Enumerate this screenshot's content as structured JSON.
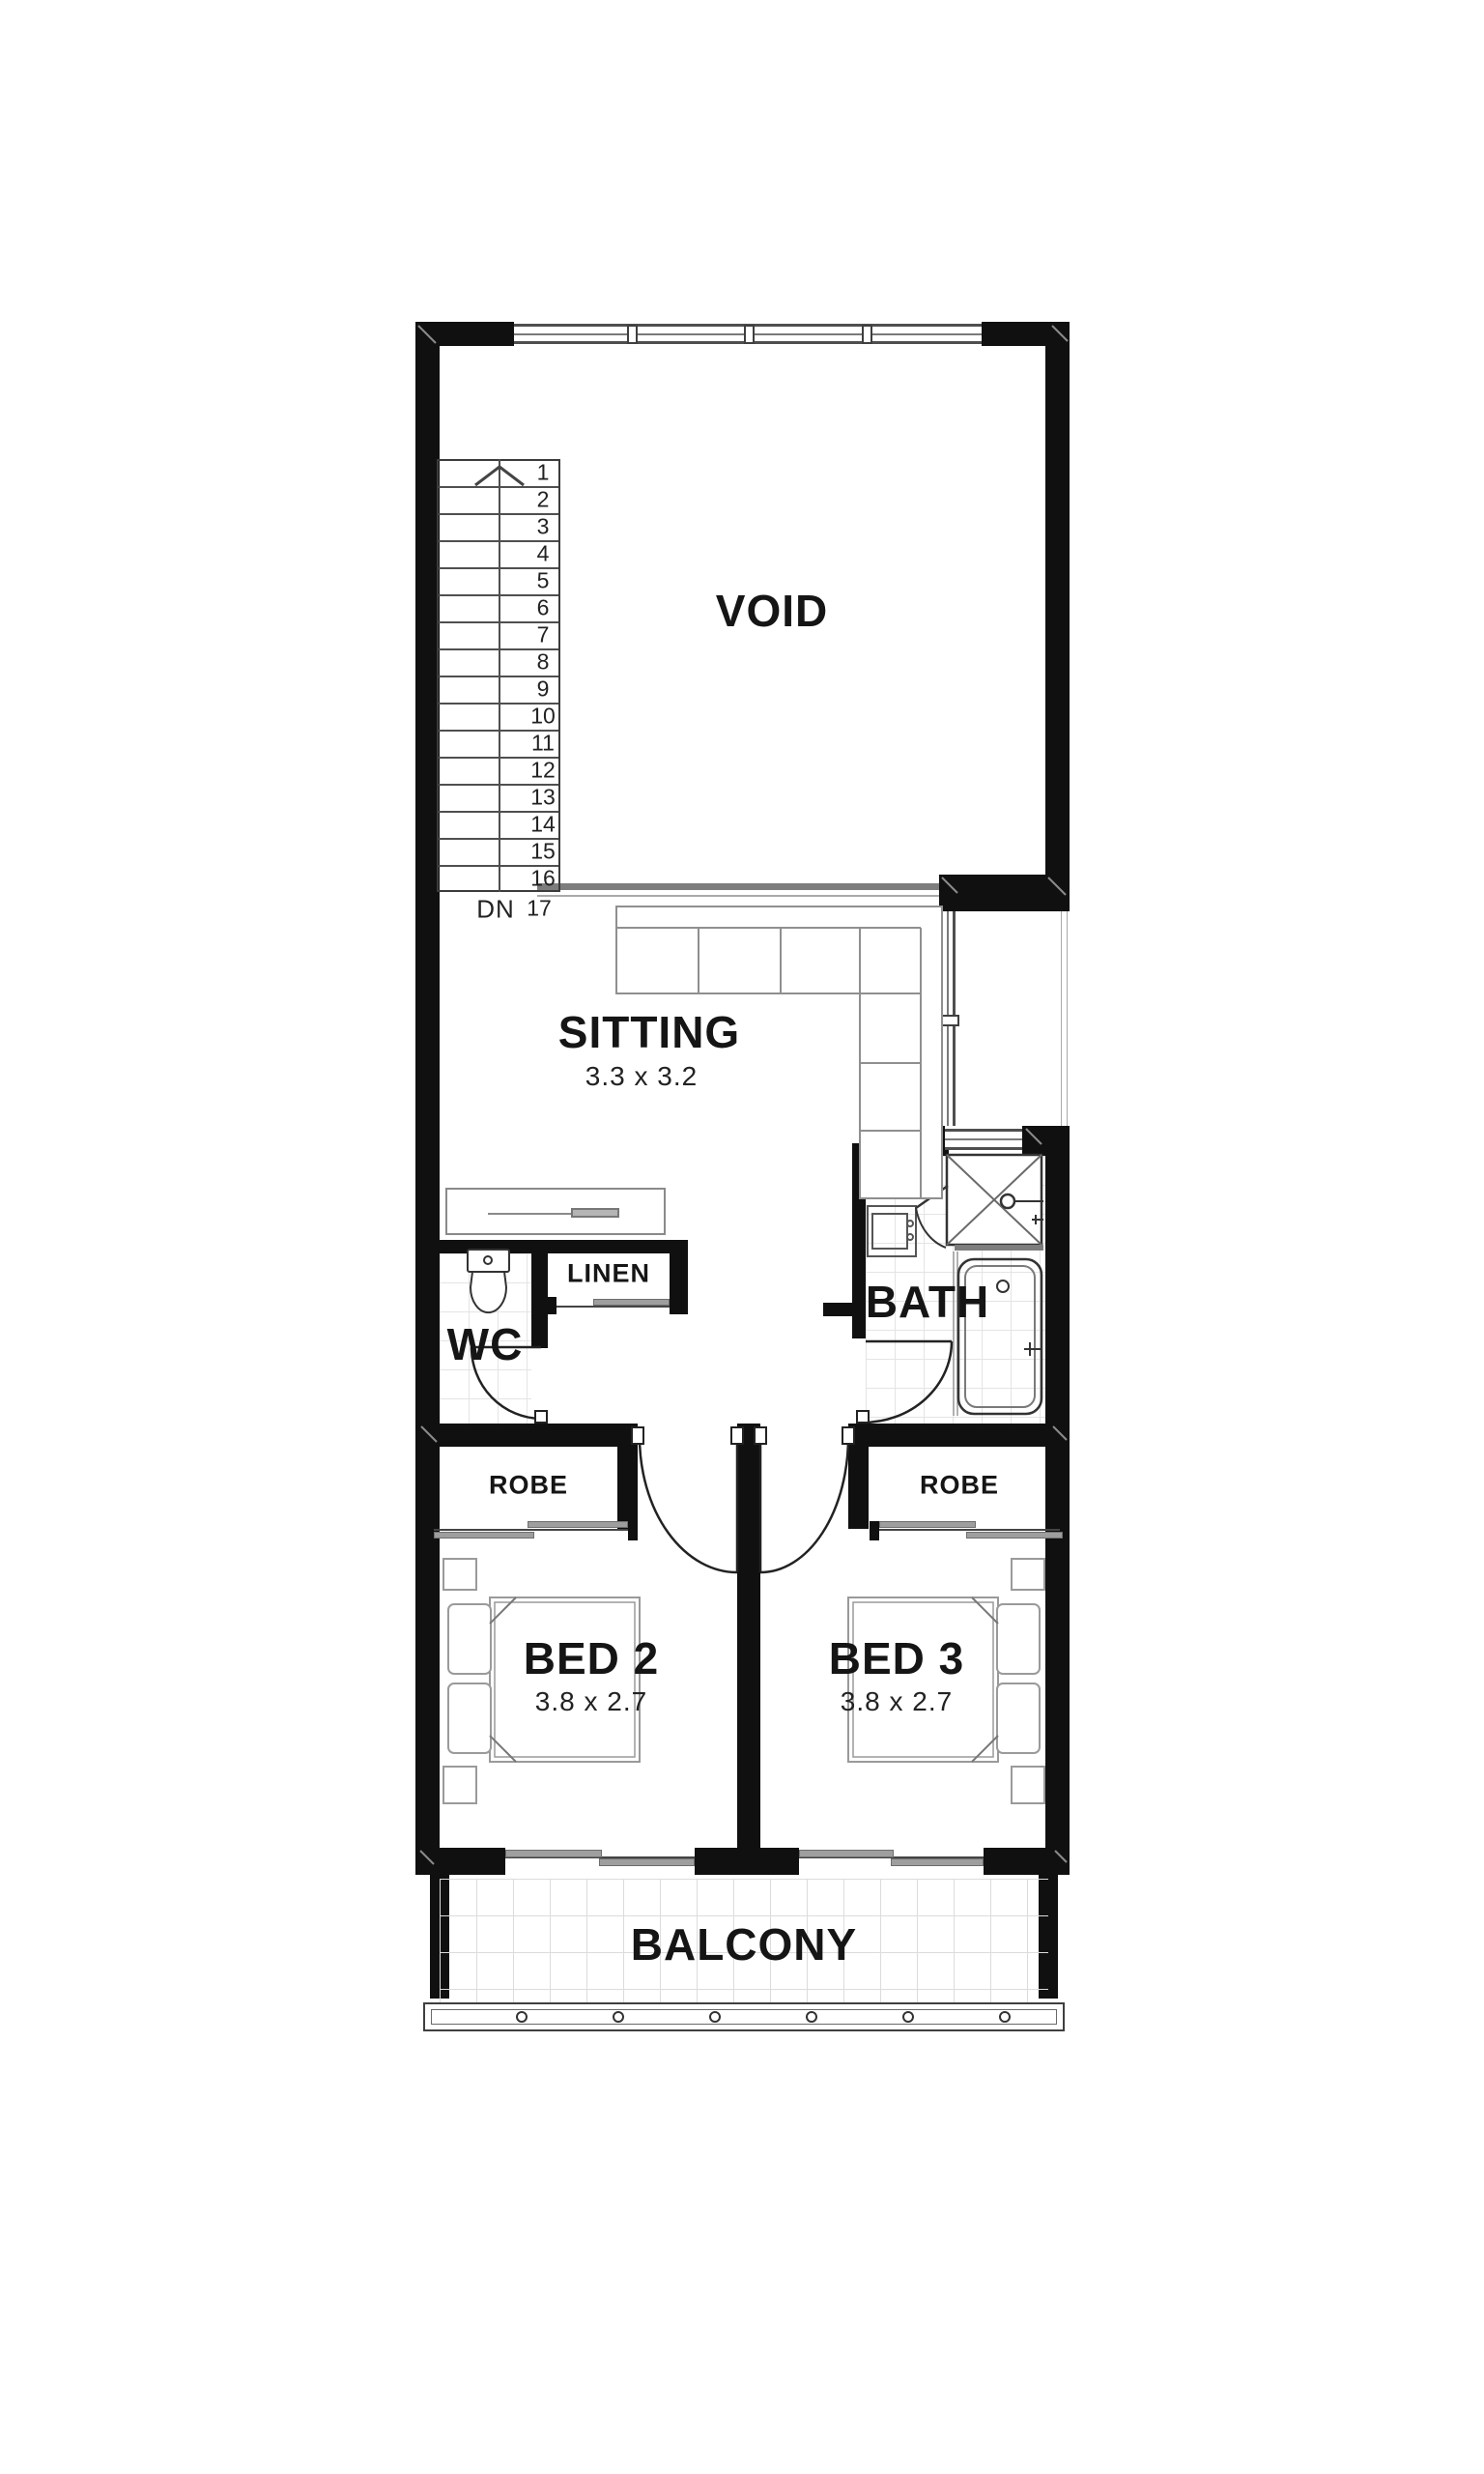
{
  "plan": {
    "rooms": {
      "void": {
        "label": "VOID"
      },
      "sitting": {
        "label": "SITTING",
        "dimensions": "3.3 x 3.2"
      },
      "wc": {
        "label": "WC"
      },
      "linen": {
        "label": "LINEN"
      },
      "bath": {
        "label": "BATH"
      },
      "robe_left": {
        "label": "ROBE"
      },
      "robe_right": {
        "label": "ROBE"
      },
      "bed2": {
        "label": "BED 2",
        "dimensions": "3.8 x 2.7"
      },
      "bed3": {
        "label": "BED 3",
        "dimensions": "3.8 x 2.7"
      },
      "balcony": {
        "label": "BALCONY"
      }
    },
    "stairs": {
      "down_label": "DN",
      "numbers": [
        "1",
        "2",
        "3",
        "4",
        "5",
        "6",
        "7",
        "8",
        "9",
        "10",
        "11",
        "12",
        "13",
        "14",
        "15",
        "16",
        "17"
      ]
    },
    "colors": {
      "wall": "#101010",
      "window_frame": "#4f4f4f",
      "furniture_line": "#8f8f8f",
      "tile_line": "#e4e4e4",
      "void_balustrade": "#7d7d7d"
    }
  }
}
